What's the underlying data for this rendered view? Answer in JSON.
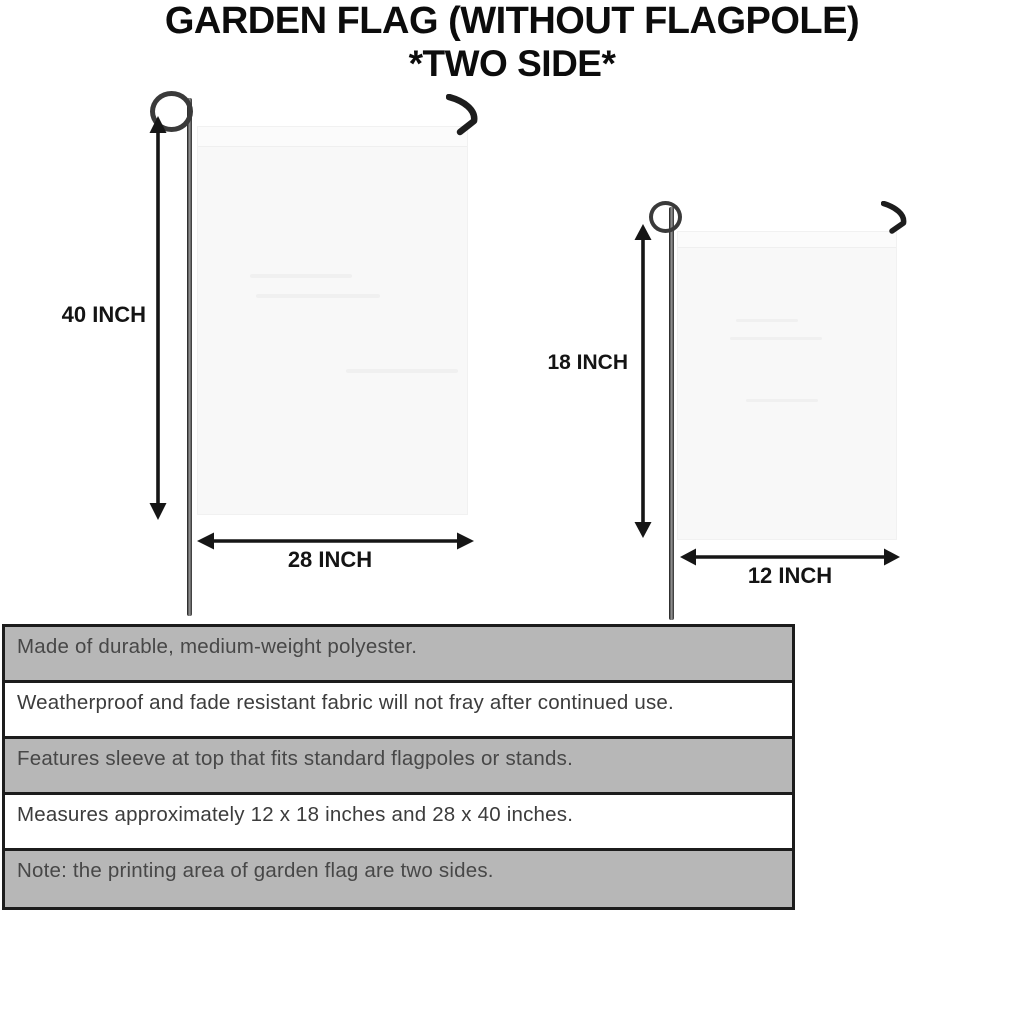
{
  "title": {
    "line1": "GARDEN FLAG (WITHOUT FLAGPOLE)",
    "line2": "*TWO SIDE*"
  },
  "diagram": {
    "large_flag": {
      "height_label": "40 INCH",
      "width_label": "28 INCH"
    },
    "small_flag": {
      "height_label": "18 INCH",
      "width_label": "12 INCH"
    },
    "icons": {
      "pole": "flagpole-rod",
      "loop": "flagpole-loop",
      "hook": "flagpole-hook",
      "dimension_arrow": "double-headed-arrow"
    }
  },
  "features": {
    "rows": [
      {
        "text": "Made of durable, medium-weight polyester.",
        "shaded": true
      },
      {
        "text": "Weatherproof and fade resistant fabric will not fray after continued use.",
        "shaded": false
      },
      {
        "text": "Features sleeve at top that fits standard flagpoles or stands.",
        "shaded": true
      },
      {
        "text": "Measures approximately 12 x 18 inches and 28 x 40 inches.",
        "shaded": false
      },
      {
        "text": "Note: the printing area of garden flag are two sides.",
        "shaded": true
      }
    ]
  },
  "colors": {
    "background": "#ffffff",
    "ink": "#111111",
    "flag_fill": "#f8f8f8",
    "shaded_row": "#b7b7b7",
    "row_text": "#474747",
    "table_border": "#1c1c1c",
    "pole": "#3a3a3a"
  }
}
